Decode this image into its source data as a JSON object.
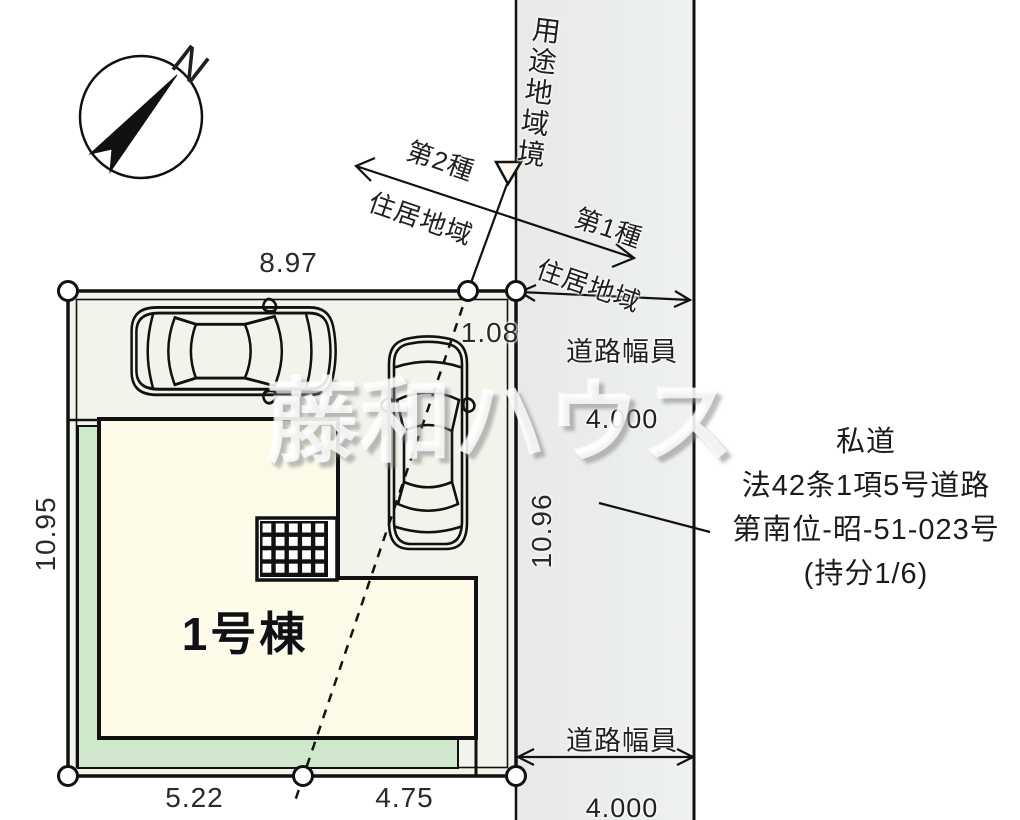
{
  "compass": {
    "north_label": "N"
  },
  "building": {
    "label": "1号棟"
  },
  "watermark": {
    "text": "藤和ハウス"
  },
  "dimensions": {
    "top_width": "8.97",
    "top_offset": "1.08",
    "left_height": "10.95",
    "road_side_height": "10.96",
    "bottom_left": "5.22",
    "bottom_right": "4.75"
  },
  "road": {
    "width_caption": "道路幅員",
    "width_value": "4.000",
    "note_lines": [
      "私道",
      "法42条1項5号道路",
      "第南位-昭-51-023号",
      "(持分1/6)"
    ]
  },
  "zoning": {
    "boundary_label": "用途地域境",
    "zone_left_line1": "第2種",
    "zone_left_line2": "住居地域",
    "zone_right_line1": "第1種",
    "zone_right_line2": "住居地域"
  },
  "colors": {
    "lot_fill": "#f0f4ea",
    "building_fill": "#fdfbe8",
    "garden_fill": "#cfe7cb",
    "road_fill": "#e9ebed",
    "line_color": "#111111"
  }
}
